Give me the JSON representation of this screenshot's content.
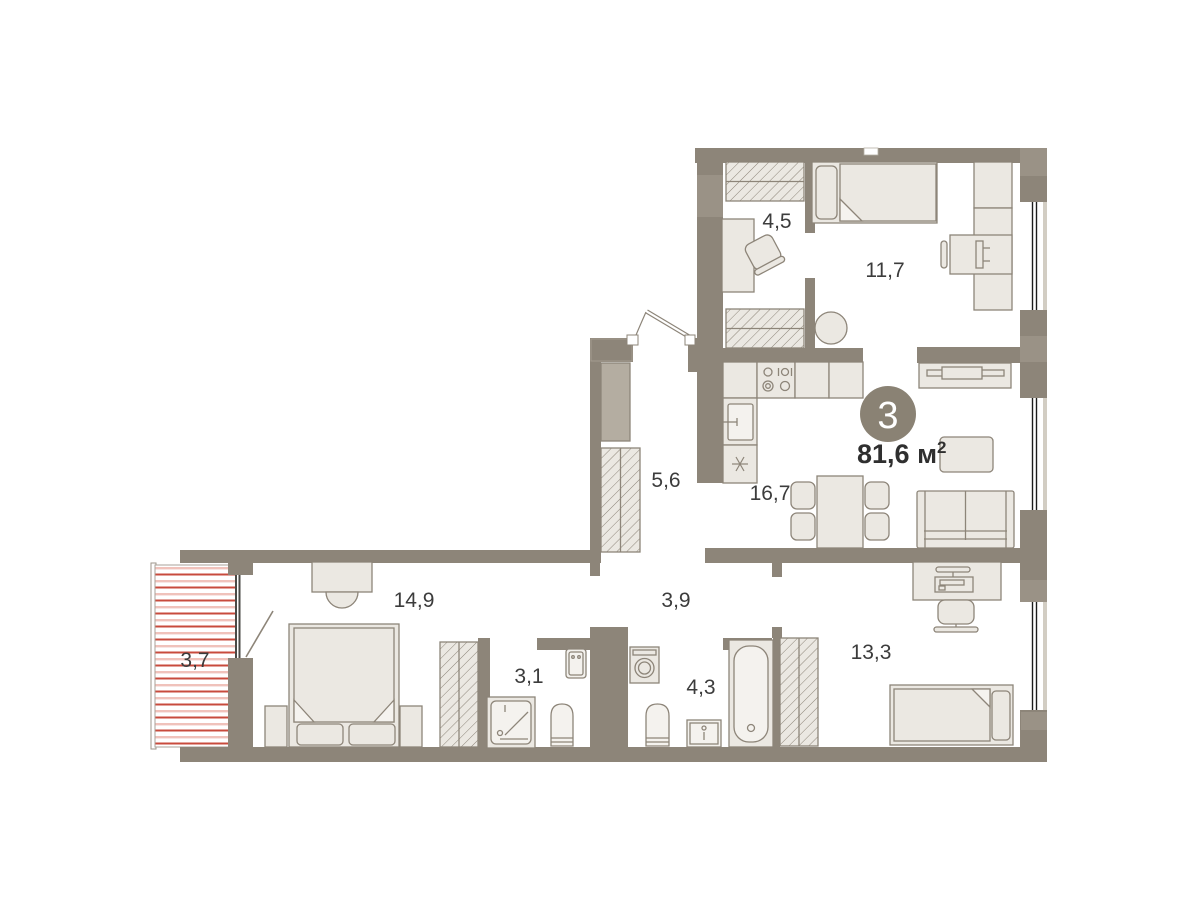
{
  "plan": {
    "title": "3-room apartment floor plan",
    "badge": {
      "room_count": "3",
      "area_value": "81,6",
      "area_unit": " м",
      "area_sup": "2"
    },
    "rooms": [
      {
        "name": "dressing-room",
        "area": "4,5"
      },
      {
        "name": "bedroom-upper",
        "area": "11,7"
      },
      {
        "name": "corridor",
        "area": "5,6"
      },
      {
        "name": "kitchen-living-room",
        "area": "16,7"
      },
      {
        "name": "hallway",
        "area": "3,9"
      },
      {
        "name": "bedroom-left",
        "area": "14,9"
      },
      {
        "name": "shower-room",
        "area": "3,1"
      },
      {
        "name": "bathroom",
        "area": "4,3"
      },
      {
        "name": "bedroom-right",
        "area": "13,3"
      },
      {
        "name": "balcony",
        "area": "3,7"
      }
    ],
    "colors": {
      "wall": "#8d8579",
      "wall_light": "#9a9286",
      "furniture_fill": "#ebe8e2",
      "furniture_stroke": "#8d8579",
      "fixture_fill": "#f4f2ee",
      "gray_cabinet": "#b4ada1",
      "balcony_stripe_dark": "#c84b3d",
      "balcony_stripe_light": "#f0c2bb",
      "glass": "#1c1c1c",
      "label_text": "#3c3c3c",
      "badge_fill": "#8a8274"
    }
  }
}
